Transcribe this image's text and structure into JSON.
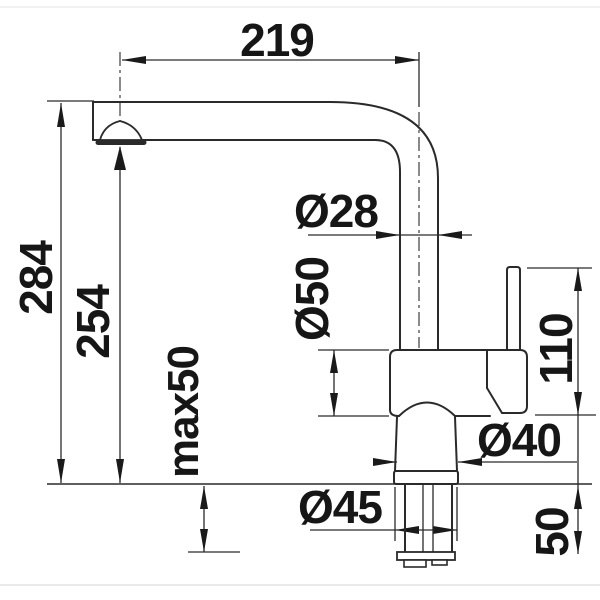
{
  "drawing": {
    "type": "technical-dimension-drawing",
    "subject": "kitchen faucet side view",
    "line_color": "#2a2a2a",
    "text_color": "#161616",
    "labels": {
      "spout_reach": "219",
      "height_total": "284",
      "height_outlet": "254",
      "max_mount_thickness": "max50",
      "spout_pipe_diameter": "Ø28",
      "body_diameter": "Ø50",
      "lever_top_height": "110",
      "base_diameter": "Ø40",
      "flange_diameter": "Ø45",
      "under_counter_depth": "50"
    }
  }
}
